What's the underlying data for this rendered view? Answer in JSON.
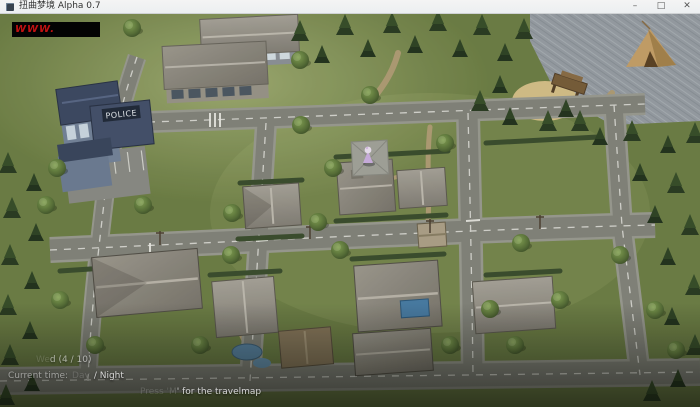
{
  "window": {
    "title": "扭曲梦境 Alpha 0.7",
    "minimize": "–",
    "maximize": "□",
    "close": "✕"
  },
  "watermark": {
    "text": "WWW."
  },
  "scene": {
    "police_sign": "POLICE"
  },
  "hud": {
    "day_faded": "We",
    "day_visible": "d (4 / 10)",
    "time_label": "Current time:",
    "time_day": "Day",
    "time_night": "/ Night",
    "hint_faded": "Press 'M",
    "hint_visible": "' for the travelmap"
  },
  "colors": {
    "grass": "#76874c",
    "road": "#878880",
    "forest_dark": "#2e4026",
    "roof_gray": "#97938a",
    "police_blue": "#3f4b66",
    "sea_gray": "#99a0a7",
    "sand": "#d8c38c",
    "watermark_red": "#c11212",
    "solar_panel_blue": "#4a7fa8",
    "character_purple": "#cfb3e4"
  }
}
